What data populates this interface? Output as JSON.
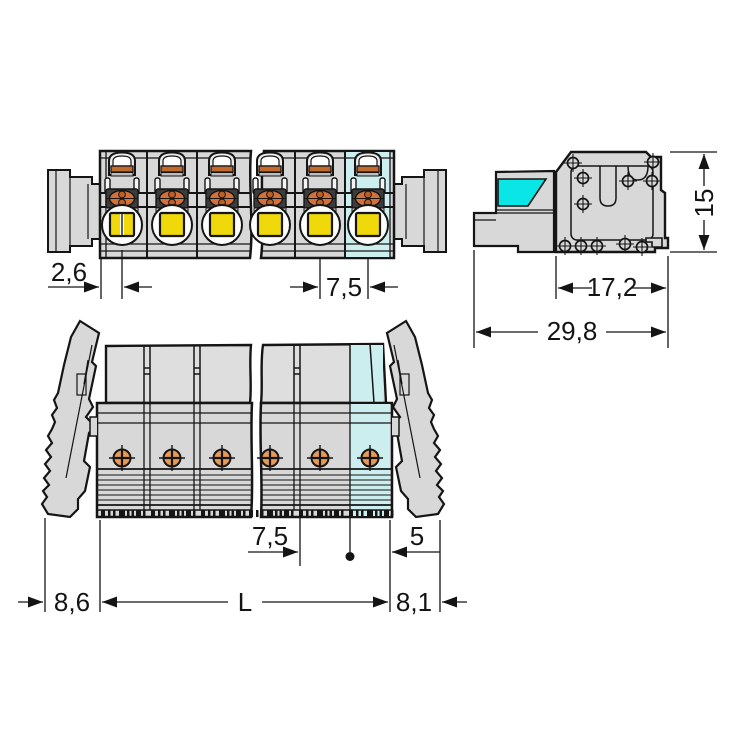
{
  "drawing": {
    "kind": "technical dimension drawing",
    "views": {
      "top": {
        "label": "top view"
      },
      "side": {
        "label": "side view"
      },
      "front": {
        "label": "front view"
      }
    }
  },
  "dims": {
    "top": {
      "pole_offset": "2,6",
      "pitch": "7,5"
    },
    "side": {
      "height": "15",
      "housing_depth": "17,2",
      "total_depth": "29,8"
    },
    "front": {
      "pitch": "7,5",
      "end_offset": "5",
      "left_overhang": "8,6",
      "length": "L",
      "right_overhang": "8,1"
    }
  },
  "colors": {
    "body_gray": "#d8d8d8",
    "outline": "#151515",
    "button_yellow": "#f0d90a",
    "clamp_orange": "#d4713a",
    "contact_orange": "#e59a55",
    "highlight_cyan_bright": "#0ae5e5",
    "highlight_cyan_pale": "#cdeeee",
    "background": "#ffffff"
  }
}
